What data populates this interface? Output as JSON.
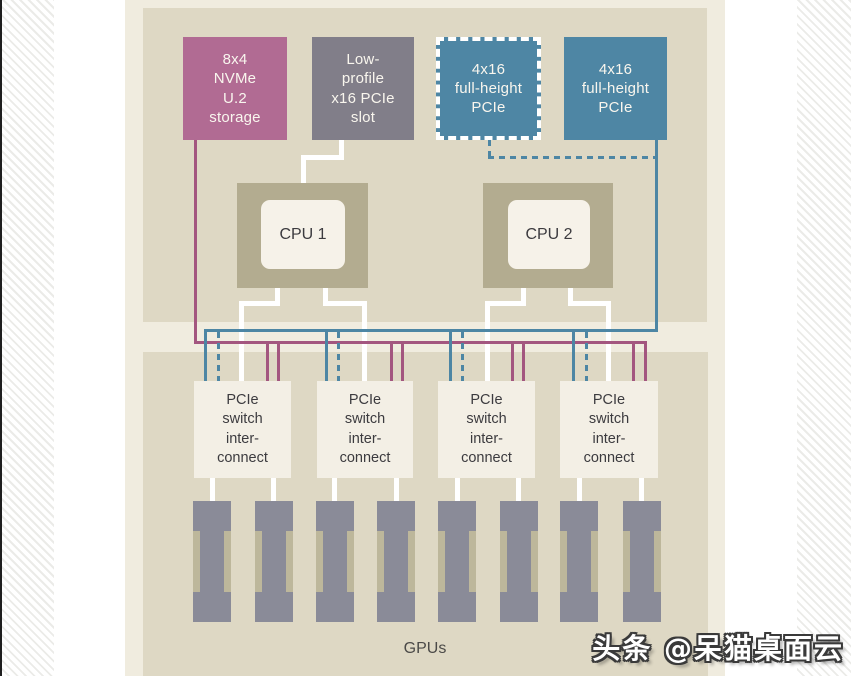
{
  "top_boxes": [
    {
      "label": "8x4\nNVMe\nU.2\nstorage"
    },
    {
      "label": "Low-\nprofile\nx16 PCIe\nslot"
    },
    {
      "label": "4x16\nfull-height\nPCIe"
    },
    {
      "label": "4x16\nfull-height\nPCIe"
    }
  ],
  "cpus": [
    {
      "label": "CPU 1"
    },
    {
      "label": "CPU 2"
    }
  ],
  "switches": [
    {
      "label": "PCIe\nswitch\ninter-\nconnect"
    },
    {
      "label": "PCIe\nswitch\ninter-\nconnect"
    },
    {
      "label": "PCIe\nswitch\ninter-\nconnect"
    },
    {
      "label": "PCIe\nswitch\ninter-\nconnect"
    }
  ],
  "gpu_label": "GPUs",
  "gpu_count": 8,
  "watermark": "头条 @呆猫桌面云",
  "colors": {
    "storage_pink": "#b16b93",
    "slot_gray": "#817e89",
    "pcie_blue": "#4e86a4",
    "panel_beige": "#ded8c4",
    "page_cream": "#f0ecdf",
    "cpu_outer_khaki": "#b3ac90",
    "line_white": "#ffffff",
    "line_pink": "#a3567f",
    "line_blue": "#4d86a4",
    "gpu_gray": "#8a8b98",
    "gpu_slot_khaki": "#bdb79b",
    "text_dark": "#3c3b3f"
  }
}
